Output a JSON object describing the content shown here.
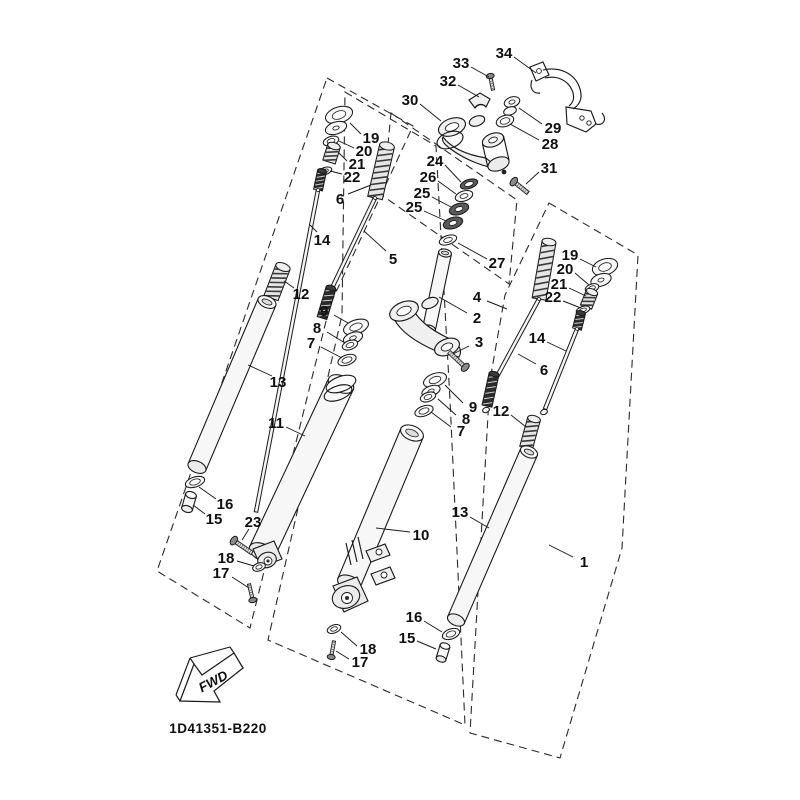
{
  "diagram": {
    "code": "1D41351-B220",
    "fwd": "FWD"
  },
  "colors": {
    "line": "#1a1a1a"
  },
  "labels": [
    {
      "t": "34",
      "x": 504,
      "y": 53,
      "l": [
        514,
        57,
        536,
        73
      ]
    },
    {
      "t": "33",
      "x": 461,
      "y": 63,
      "l": [
        471,
        67,
        489,
        77
      ]
    },
    {
      "t": "32",
      "x": 448,
      "y": 81,
      "l": [
        458,
        85,
        479,
        97
      ]
    },
    {
      "t": "30",
      "x": 410,
      "y": 100,
      "l": [
        420,
        104,
        441,
        121
      ]
    },
    {
      "t": "29",
      "x": 553,
      "y": 128,
      "l": [
        542,
        124,
        519,
        108
      ]
    },
    {
      "t": "28",
      "x": 550,
      "y": 144,
      "l": [
        539,
        140,
        510,
        124
      ]
    },
    {
      "t": "31",
      "x": 549,
      "y": 168,
      "l": [
        539,
        172,
        526,
        184
      ]
    },
    {
      "t": "19",
      "x": 371,
      "y": 138,
      "l": [
        361,
        134,
        350,
        123
      ]
    },
    {
      "t": "20",
      "x": 364,
      "y": 151,
      "l": [
        354,
        148,
        339,
        141
      ]
    },
    {
      "t": "21",
      "x": 357,
      "y": 164,
      "l": [
        347,
        161,
        339,
        153
      ]
    },
    {
      "t": "22",
      "x": 352,
      "y": 177,
      "l": [
        342,
        174,
        330,
        171
      ]
    },
    {
      "t": "24",
      "x": 435,
      "y": 161,
      "l": [
        445,
        165,
        461,
        182
      ]
    },
    {
      "t": "26",
      "x": 428,
      "y": 177,
      "l": [
        438,
        181,
        456,
        194
      ]
    },
    {
      "t": "25",
      "x": 422,
      "y": 193,
      "l": [
        432,
        197,
        451,
        207
      ]
    },
    {
      "t": "25",
      "x": 414,
      "y": 207,
      "l": [
        424,
        211,
        446,
        221
      ]
    },
    {
      "t": "27",
      "x": 497,
      "y": 263,
      "l": [
        487,
        259,
        458,
        243
      ]
    },
    {
      "t": "6",
      "x": 340,
      "y": 199,
      "l": [
        348,
        194,
        371,
        185
      ]
    },
    {
      "t": "14",
      "x": 322,
      "y": 240,
      "l": [
        317,
        232,
        310,
        225
      ]
    },
    {
      "t": "5",
      "x": 393,
      "y": 259,
      "l": [
        386,
        251,
        364,
        231
      ]
    },
    {
      "t": "12",
      "x": 301,
      "y": 294,
      "l": [
        294,
        288,
        284,
        281
      ]
    },
    {
      "t": "2",
      "x": 477,
      "y": 318,
      "l": [
        467,
        313,
        439,
        297
      ]
    },
    {
      "t": "4",
      "x": 477,
      "y": 297,
      "l": [
        487,
        301,
        507,
        309
      ]
    },
    {
      "t": "3",
      "x": 479,
      "y": 342,
      "l": [
        469,
        346,
        453,
        354
      ]
    },
    {
      "t": "9",
      "x": 324,
      "y": 311,
      "l": [
        334,
        315,
        348,
        323
      ]
    },
    {
      "t": "8",
      "x": 317,
      "y": 328,
      "l": [
        327,
        332,
        345,
        343
      ]
    },
    {
      "t": "7",
      "x": 311,
      "y": 343,
      "l": [
        321,
        347,
        342,
        358
      ]
    },
    {
      "t": "19",
      "x": 570,
      "y": 255,
      "l": [
        580,
        259,
        596,
        267
      ]
    },
    {
      "t": "20",
      "x": 565,
      "y": 269,
      "l": [
        575,
        273,
        589,
        285
      ]
    },
    {
      "t": "21",
      "x": 559,
      "y": 284,
      "l": [
        569,
        288,
        586,
        296
      ]
    },
    {
      "t": "22",
      "x": 553,
      "y": 297,
      "l": [
        563,
        301,
        581,
        308
      ]
    },
    {
      "t": "14",
      "x": 537,
      "y": 338,
      "l": [
        547,
        342,
        566,
        351
      ]
    },
    {
      "t": "6",
      "x": 544,
      "y": 370,
      "l": [
        536,
        364,
        518,
        354
      ]
    },
    {
      "t": "12",
      "x": 501,
      "y": 411,
      "l": [
        511,
        415,
        526,
        427
      ]
    },
    {
      "t": "9",
      "x": 473,
      "y": 407,
      "l": [
        463,
        403,
        445,
        385
      ]
    },
    {
      "t": "8",
      "x": 466,
      "y": 419,
      "l": [
        456,
        415,
        438,
        399
      ]
    },
    {
      "t": "7",
      "x": 461,
      "y": 431,
      "l": [
        451,
        427,
        431,
        412
      ]
    },
    {
      "t": "13",
      "x": 278,
      "y": 382,
      "l": [
        272,
        376,
        248,
        365
      ]
    },
    {
      "t": "11",
      "x": 276,
      "y": 423,
      "l": [
        286,
        427,
        305,
        436
      ]
    },
    {
      "t": "16",
      "x": 225,
      "y": 504,
      "l": [
        216,
        499,
        199,
        487
      ]
    },
    {
      "t": "15",
      "x": 214,
      "y": 519,
      "l": [
        205,
        514,
        193,
        505
      ]
    },
    {
      "t": "23",
      "x": 253,
      "y": 522,
      "l": [
        249,
        529,
        242,
        540
      ]
    },
    {
      "t": "18",
      "x": 226,
      "y": 558,
      "l": [
        237,
        561,
        254,
        566
      ]
    },
    {
      "t": "17",
      "x": 221,
      "y": 573,
      "l": [
        232,
        577,
        249,
        588
      ]
    },
    {
      "t": "13",
      "x": 460,
      "y": 512,
      "l": [
        470,
        517,
        489,
        528
      ]
    },
    {
      "t": "10",
      "x": 421,
      "y": 535,
      "l": [
        410,
        532,
        376,
        528
      ]
    },
    {
      "t": "1",
      "x": 584,
      "y": 562,
      "l": [
        573,
        557,
        549,
        545
      ]
    },
    {
      "t": "16",
      "x": 414,
      "y": 617,
      "l": [
        424,
        621,
        442,
        632
      ]
    },
    {
      "t": "15",
      "x": 407,
      "y": 638,
      "l": [
        417,
        641,
        436,
        649
      ]
    },
    {
      "t": "18",
      "x": 368,
      "y": 649,
      "l": [
        357,
        646,
        341,
        632
      ]
    },
    {
      "t": "17",
      "x": 360,
      "y": 662,
      "l": [
        349,
        659,
        336,
        651
      ]
    }
  ]
}
